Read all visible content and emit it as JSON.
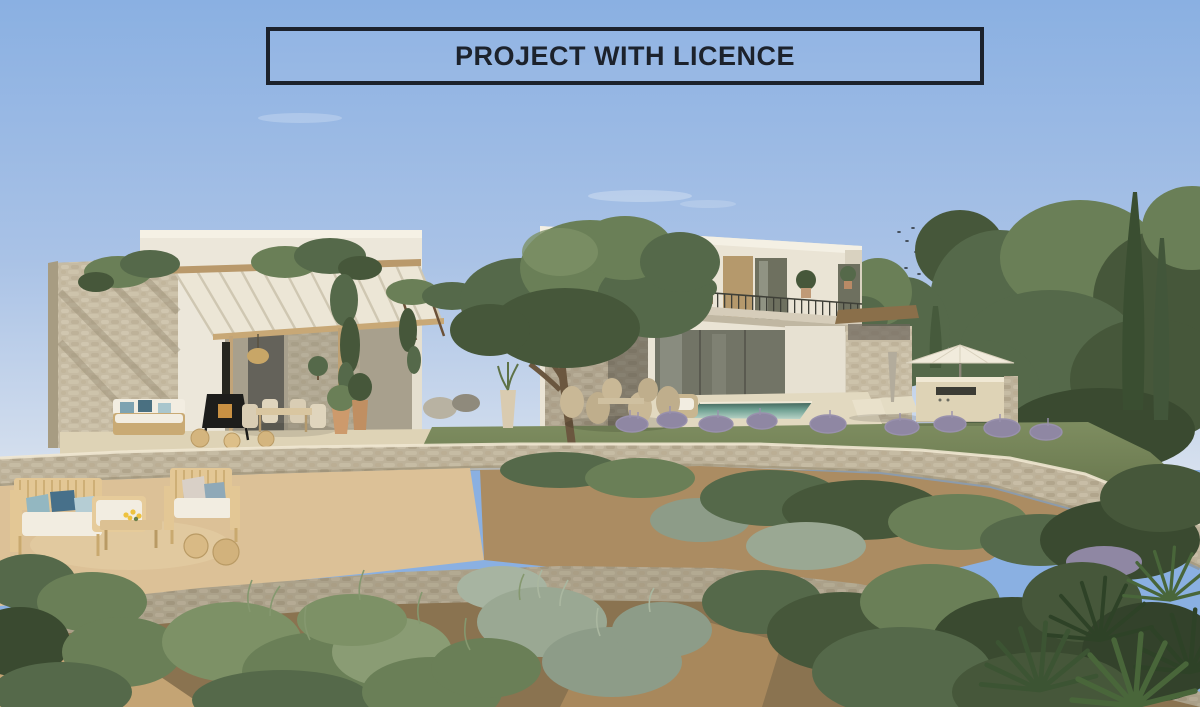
{
  "banner": {
    "text": "PROJECT WITH LICENCE"
  },
  "scene": {
    "type": "architectural-rendering",
    "subject": "Modern Mediterranean villa with swimming pool, pergola terraces and landscaped dry garden",
    "elements": [
      "sky",
      "bird-flock",
      "stone-accent-wall",
      "pergola",
      "hanging-vines",
      "single-storey-wing",
      "two-storey-wing",
      "balcony",
      "olive-tree",
      "swimming-pool",
      "parasol",
      "outdoor-kitchen",
      "sun-loungers",
      "lawn",
      "stone-retaining-walls",
      "outdoor-lounge-furniture",
      "wood-burning-stove",
      "wicker-poufs",
      "garden-shrubs",
      "lavender",
      "cypress-trees",
      "fan-palm"
    ],
    "palette": {
      "sky_top": "#8ab0e2",
      "sky_horizon": "#d6e0ee",
      "banner_ink": "#1c222c",
      "wall_white": "#ece7da",
      "stone": "#c6bba3",
      "wood": "#c9aa74",
      "pool_far": "#3f6157",
      "pool_near": "#b7d2c6",
      "lawn": "#76855a",
      "shrub_green": "#55694a",
      "shrub_silver": "#9aa893",
      "lavender": "#8f87a3",
      "earth": "#ab8c62"
    }
  }
}
